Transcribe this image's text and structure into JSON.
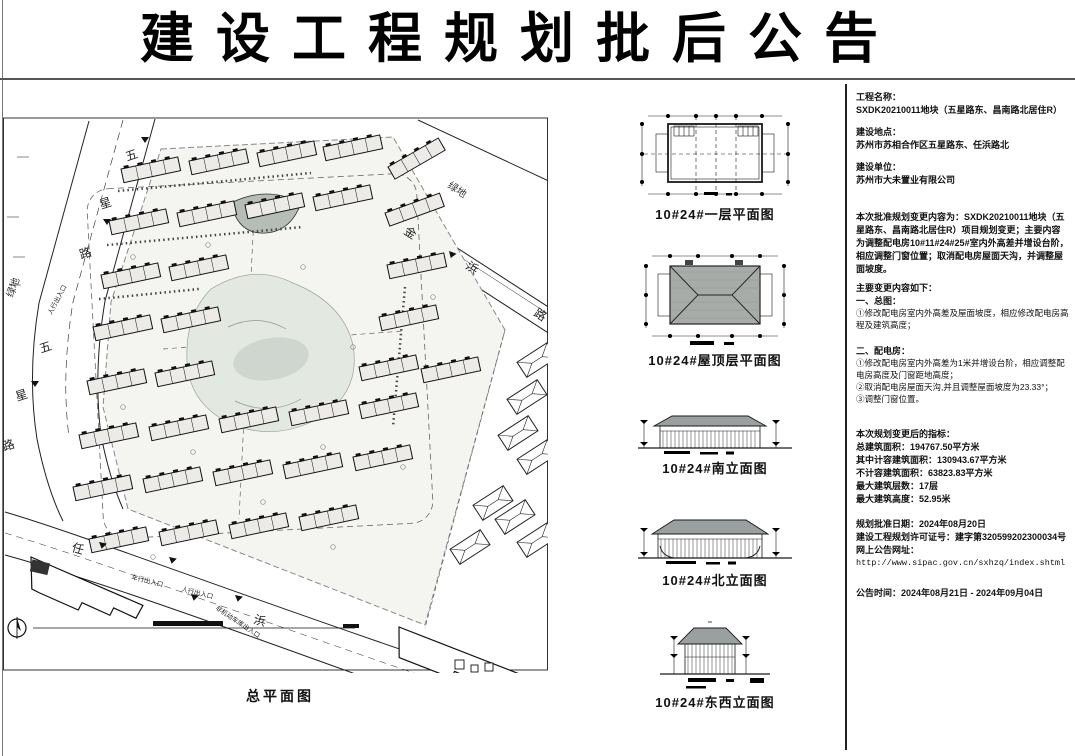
{
  "title": "建设工程规划批后公告",
  "site_plan": {
    "caption": "总平面图",
    "roads": {
      "west": {
        "name": "五星路",
        "chars": [
          "五",
          "星",
          "路"
        ]
      },
      "northeast": {
        "name": "金浜路",
        "chars": [
          "金",
          "浜",
          "路"
        ]
      },
      "south": {
        "name": "任浜路",
        "chars": [
          "任",
          "浜"
        ]
      }
    },
    "areas": {
      "green_west": "绿地",
      "green_northeast": "绿地"
    },
    "entrances": {
      "pedestrian": "人行出入口",
      "vehicle": "车行出入口",
      "nonmotor_garage": "非机动车库出入口"
    },
    "icons": {
      "north_arrow": "north-arrow-compass",
      "entrance_arrow": "filled-triangle"
    }
  },
  "drawings": [
    {
      "caption": "10#24#一层平面图"
    },
    {
      "caption": "10#24#屋顶层平面图"
    },
    {
      "caption": "10#24#南立面图"
    },
    {
      "caption": "10#24#北立面图"
    },
    {
      "caption": "10#24#东西立面图"
    }
  ],
  "info_panel": {
    "project_name_label": "工程名称：",
    "project_name": "SXDK20210011地块（五星路东、昌南路北居住R）",
    "location_label": "建设地点：",
    "location": "苏州市苏相合作区五星路东、任浜路北",
    "builder_label": "建设单位：",
    "builder": "苏州市大未置业有限公司",
    "change_summary": "本次批准规划变更内容为：SXDK20210011地块（五星路东、昌南路北居住R）项目规划变更；主要内容为调整配电房10#11#24#25#室内外高差并增设台阶，相应调整门窗位置；取消配电房屋面天沟，并调整屋面坡度。",
    "changes_heading": "主要变更内容如下：",
    "section1_heading": "一、总图：",
    "section1_items": [
      "①修改配电房室内外高差及屋面坡度，相应修改配电房高程及建筑高度；"
    ],
    "section2_heading": "二、配电房：",
    "section2_items": [
      "①修改配电房室内外高差为1米并增设台阶，相应调整配电房高度及门窗距地高度；",
      "②取消配电房屋面天沟,并且调整屋面坡度为23.33°；",
      "③调整门窗位置。"
    ],
    "indicators_heading": "本次规划变更后的指标：",
    "indicators": [
      "总建筑面积：194767.50平方米",
      "其中计容建筑面积：130943.67平方米",
      "不计容建筑面积：63823.83平方米",
      "最大建筑层数：17层",
      "最大建筑高度：52.95米"
    ],
    "approval_date": "规划批准日期：2024年08月20日",
    "permit_no": "建设工程规划许可证号：建字第320599202300034号",
    "url_label": "网上公告网址：",
    "url": "http://www.sipac.gov.cn/sxhzq/index.shtml",
    "announce_period": "公告时间：2024年08月21日 - 2024年09月04日"
  }
}
